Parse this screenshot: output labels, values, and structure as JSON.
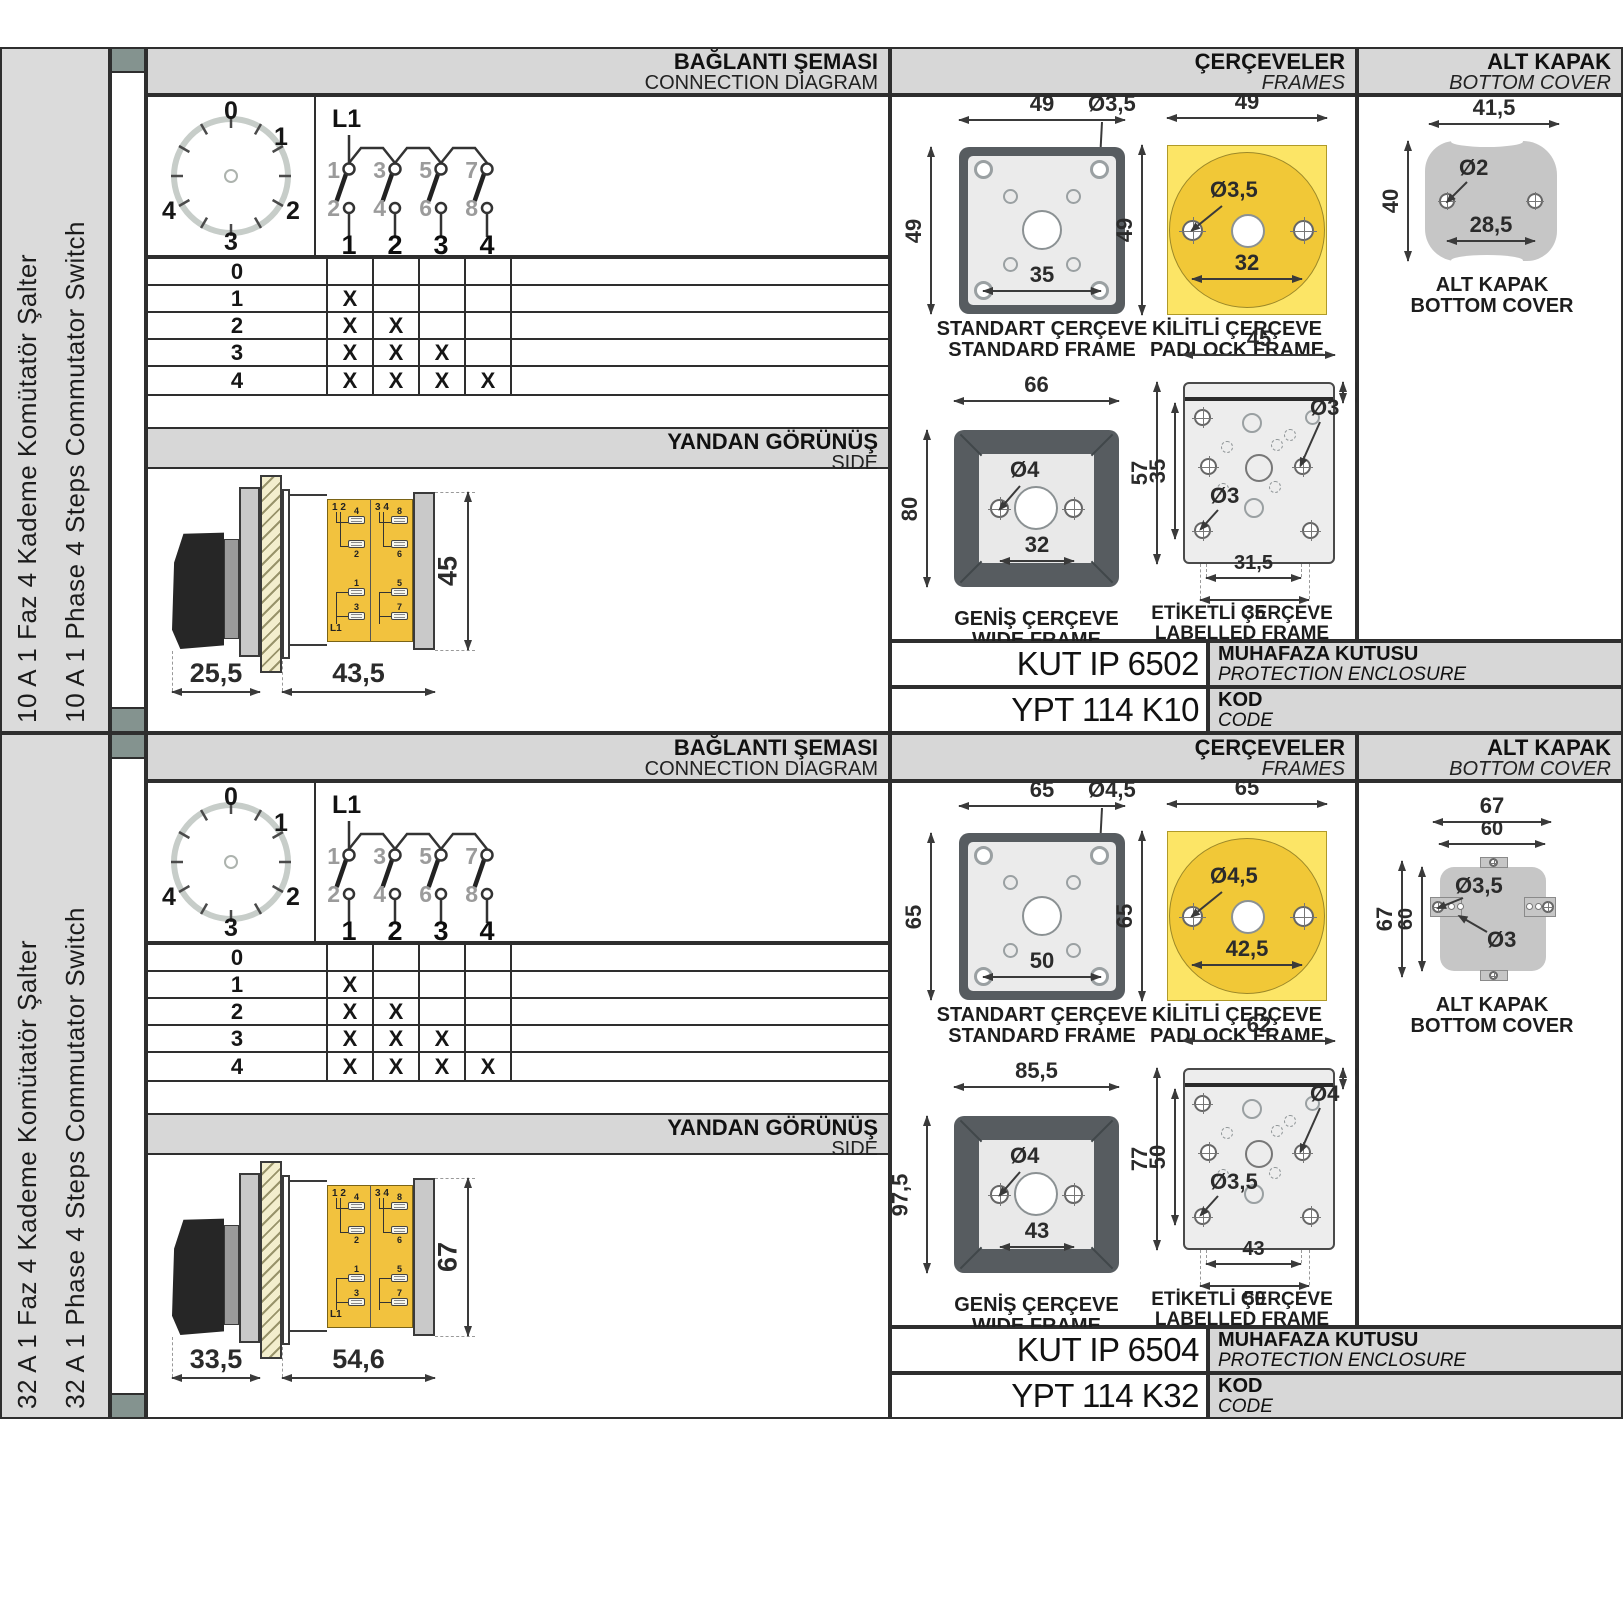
{
  "colors": {
    "header_bg": "#d7d7d7",
    "sidebar_bg": "#dbdbdb",
    "line": "#2e2e2e",
    "padlock_yellow_square": "#fce566",
    "padlock_yellow_circle": "#f1c837",
    "terminal_block_yellow": "#f2c23e",
    "frame_dark_gray": "#575c60",
    "frame_panel_light": "#ebebeb",
    "cover_gray": "#c6c6c6",
    "binder_square": "#84938f"
  },
  "headers": {
    "connection_tr": "BAĞLANTI ŞEMASI",
    "connection_en": "CONNECTION DIAGRAM",
    "frames_tr": "ÇERÇEVELER",
    "frames_en": "FRAMES",
    "bottom_cover_tr": "ALT KAPAK",
    "bottom_cover_en": "BOTTOM COVER",
    "side_tr": "YANDAN GÖRÜNÜŞ",
    "side_en": "SIDE"
  },
  "captions": {
    "standard_tr": "STANDART ÇERÇEVE",
    "standard_en": "STANDARD FRAME",
    "padlock_tr": "KİLİTLİ ÇERÇEVE",
    "padlock_en": "PADLOCK FRAME",
    "wide_tr": "GENİŞ ÇERÇEVE",
    "wide_en": "WIDE FRAME",
    "labelled_tr": "ETİKETLİ ÇERÇEVE",
    "labelled_en": "LABELLED FRAME",
    "bottom_cover_tr": "ALT KAPAK",
    "bottom_cover_en": "BOTTOM COVER",
    "enclosure_tr": "MUHAFAZA KUTUSU",
    "enclosure_en": "PROTECTION ENCLOSURE",
    "code_tr": "KOD",
    "code_en": "CODE"
  },
  "connection": {
    "l1": "L1",
    "dial_positions": [
      "0",
      "1",
      "2",
      "3",
      "4"
    ],
    "top_contacts": [
      "1",
      "3",
      "5",
      "7"
    ],
    "bottom_contacts": [
      "2",
      "4",
      "6",
      "8"
    ],
    "switch_numbers": [
      "1",
      "2",
      "3",
      "4"
    ]
  },
  "truth_table": {
    "rows": [
      {
        "label": "0",
        "cells": [
          "",
          "",
          "",
          ""
        ]
      },
      {
        "label": "1",
        "cells": [
          "X",
          "",
          "",
          ""
        ]
      },
      {
        "label": "2",
        "cells": [
          "X",
          "X",
          "",
          ""
        ]
      },
      {
        "label": "3",
        "cells": [
          "X",
          "X",
          "X",
          ""
        ]
      },
      {
        "label": "4",
        "cells": [
          "X",
          "X",
          "X",
          "X"
        ]
      }
    ]
  },
  "terminal_block": {
    "group1": "1 2",
    "group2": "3 4",
    "l1": "L1",
    "labels": [
      "4",
      "2",
      "1",
      "3",
      "8",
      "6",
      "5",
      "7"
    ]
  },
  "sections": [
    {
      "sidebar_tr": "10 A 1 Faz 4 Kademe Komütatör Şalter",
      "sidebar_en": "10 A 1 Phase 4 Steps Commutator Switch",
      "side_view": {
        "depth_front": "25,5",
        "depth_body": "43,5",
        "height": "45"
      },
      "standard_frame": {
        "width": "49",
        "height": "49",
        "hole": "Ø3,5",
        "span": "35"
      },
      "padlock_frame": {
        "width": "49",
        "height": "49",
        "hole": "Ø3,5",
        "span": "32"
      },
      "wide_frame": {
        "width": "66",
        "height": "80",
        "hole": "Ø4",
        "span": "32"
      },
      "labelled_frame": {
        "width": "45",
        "strip": "6,5",
        "height": "57",
        "inner": "35",
        "hole_top": "Ø3",
        "hole_bottom": "Ø3",
        "span_inner": "31,5",
        "span_outer": "35"
      },
      "bottom_cover": {
        "width": "41,5",
        "height": "40",
        "hole": "Ø2",
        "span": "28,5"
      },
      "enclosure_code": "KUT IP 6502",
      "product_code": "YPT 114 K10"
    },
    {
      "sidebar_tr": "32 A 1 Faz 4 Kademe Komütatör Şalter",
      "sidebar_en": "32 A 1 Phase 4 Steps Commutator Switch",
      "side_view": {
        "depth_front": "33,5",
        "depth_body": "54,6",
        "height": "67"
      },
      "standard_frame": {
        "width": "65",
        "height": "65",
        "hole": "Ø4,5",
        "span": "50"
      },
      "padlock_frame": {
        "width": "65",
        "height": "65",
        "hole": "Ø4,5",
        "span": "42,5"
      },
      "wide_frame": {
        "width": "85,5",
        "height": "97,5",
        "hole": "Ø4",
        "span": "43"
      },
      "labelled_frame": {
        "width": "62",
        "strip": "9,5",
        "height": "77",
        "inner": "50",
        "hole_top": "Ø4",
        "hole_bottom": "Ø3,5",
        "span_inner": "43",
        "span_outer": "50"
      },
      "bottom_cover": {
        "width_outer": "67",
        "width_inner": "60",
        "height_outer": "67",
        "height_inner": "60",
        "hole_tab": "Ø3,5",
        "hole_center": "Ø3"
      },
      "enclosure_code": "KUT IP 6504",
      "product_code": "YPT 114 K32"
    }
  ]
}
